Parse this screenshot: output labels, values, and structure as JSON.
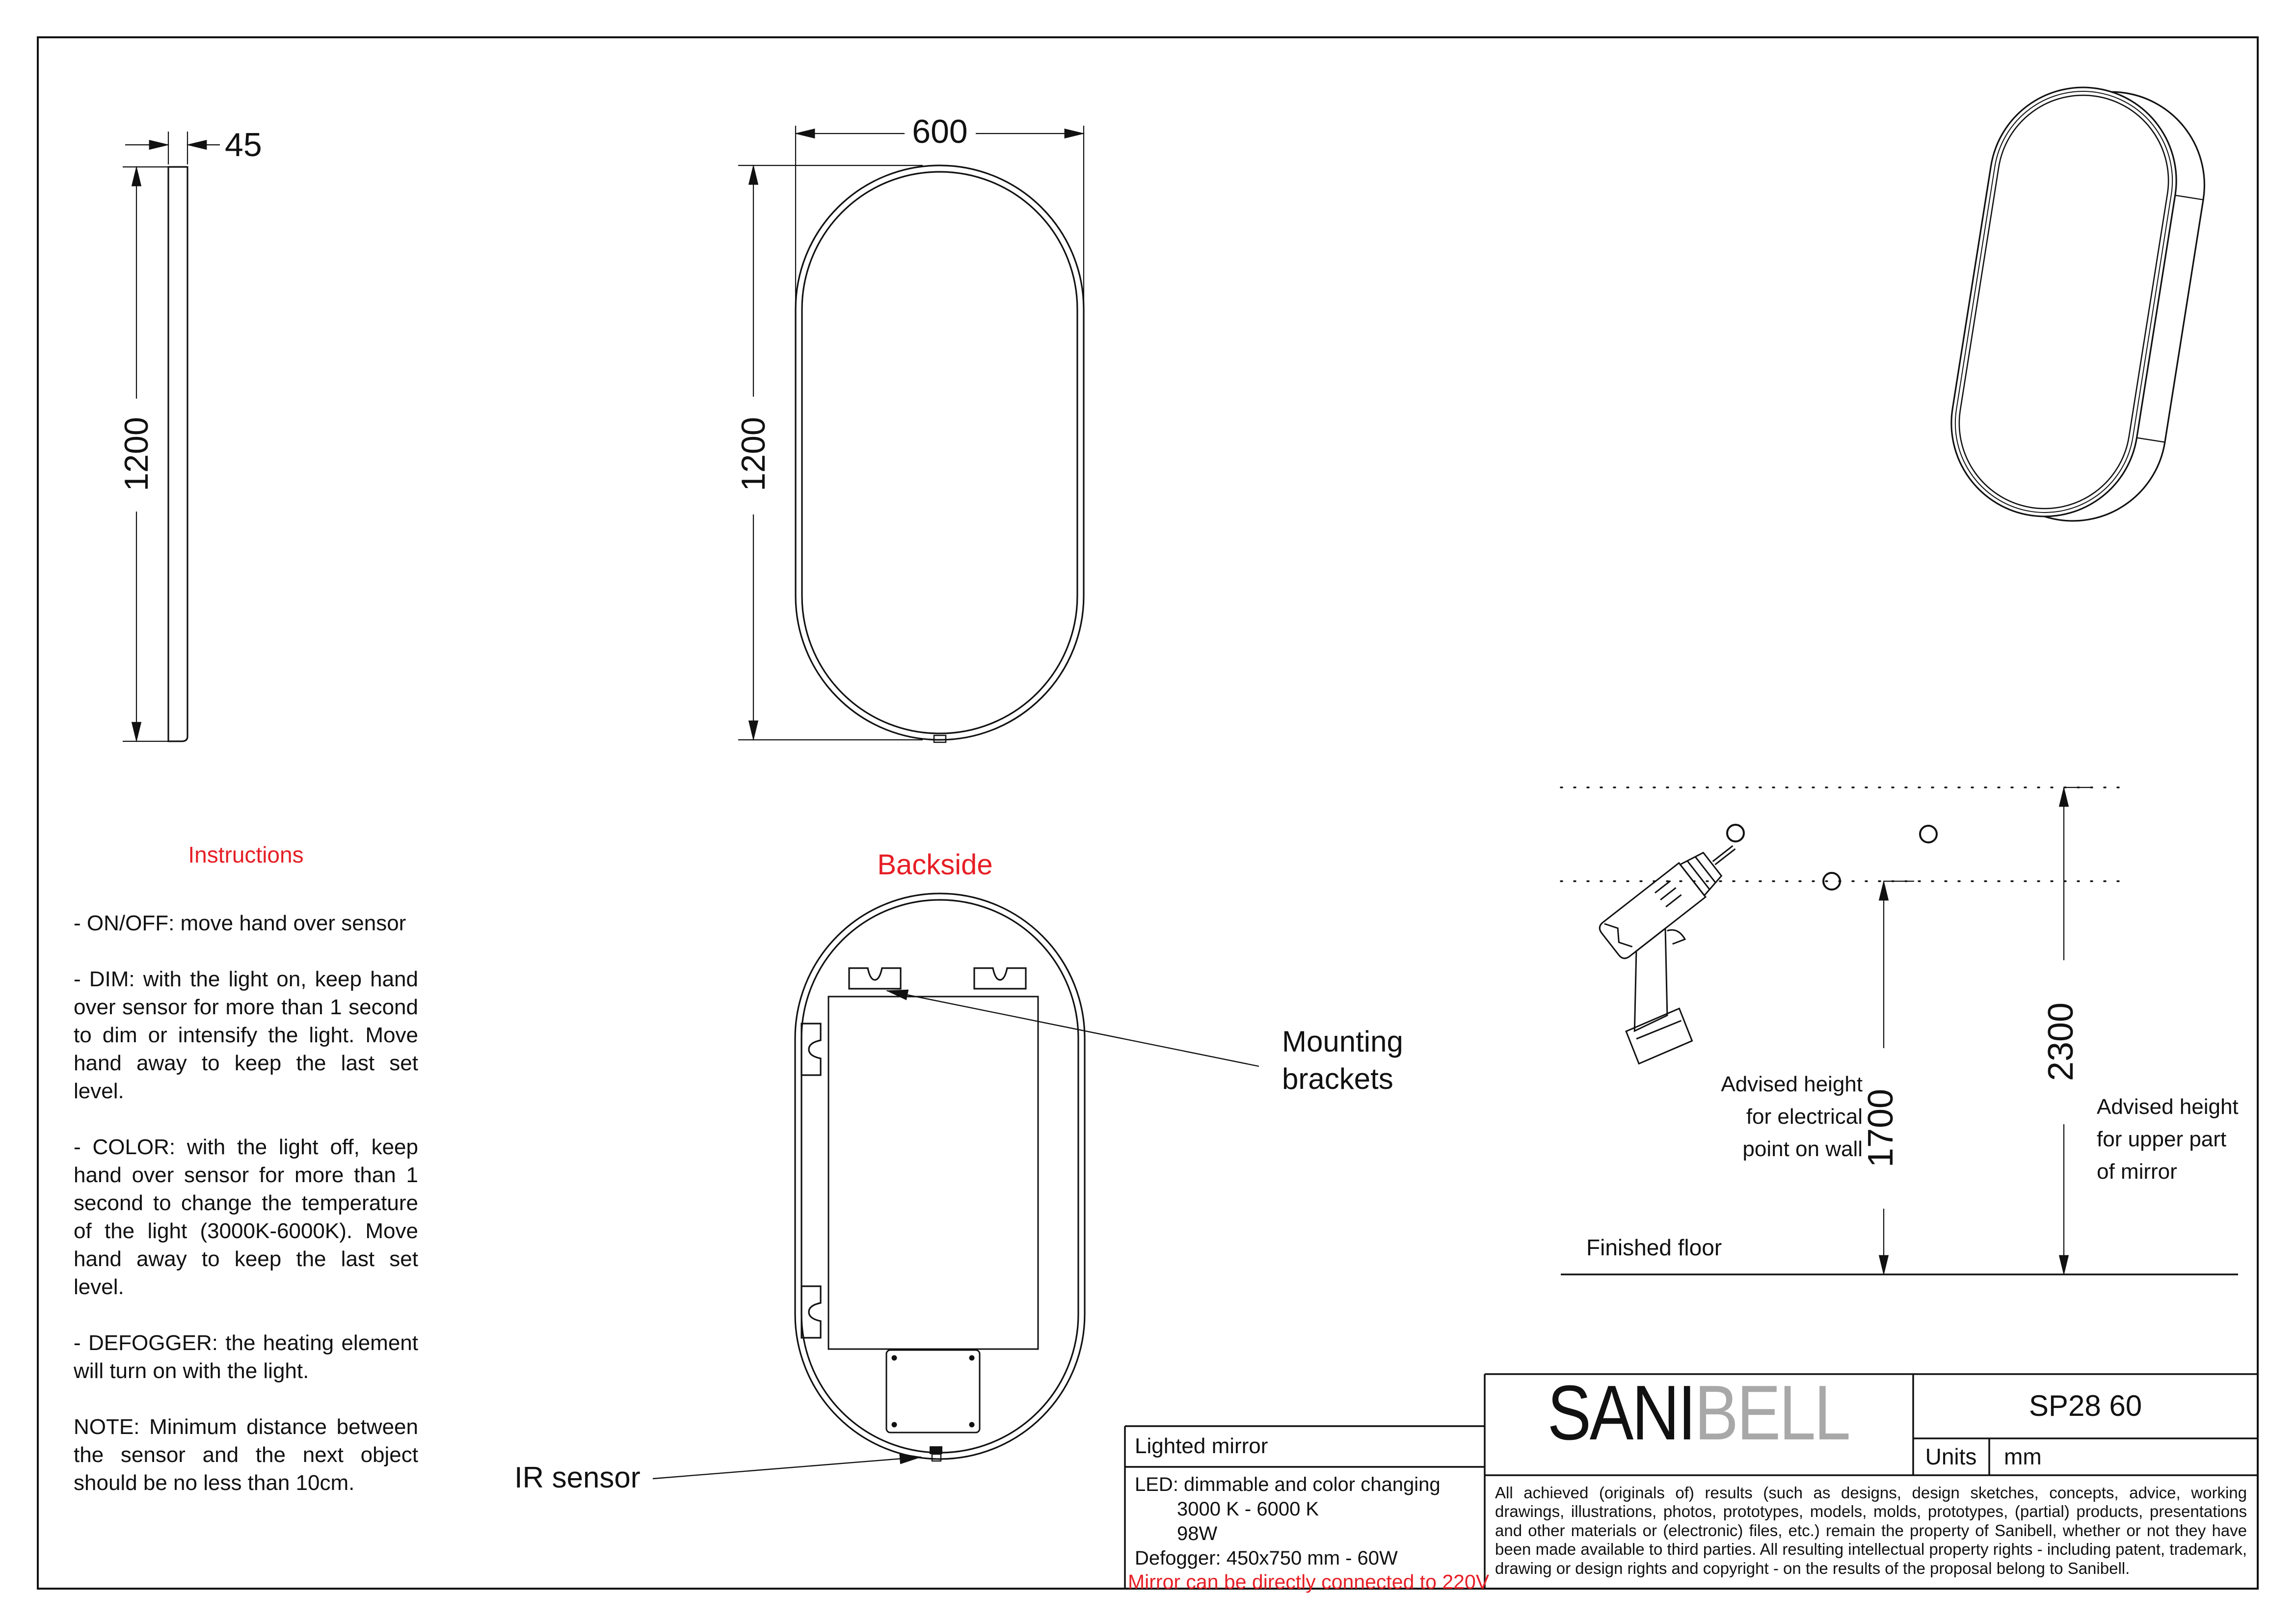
{
  "colors": {
    "accent_red": "#e61e25",
    "brand_gray": "#a8a8a8",
    "ink": "#111111"
  },
  "side_view": {
    "thickness": "45",
    "height": "1200"
  },
  "front_view": {
    "width": "600",
    "height": "1200"
  },
  "instructions": {
    "title": "Instructions",
    "items": [
      "- ON/OFF: move hand over sensor",
      "- DIM: with the light on, keep hand over sensor for more than 1 second to dim or intensify the light. Move hand away to keep the last set level.",
      "- COLOR: with the light off, keep hand over sensor for more than 1 second to change the temperature of the light (3000K-6000K). Move hand away to keep the last set level.",
      "- DEFOGGER: the heating element will turn on with the light.",
      "NOTE: Minimum distance between the sensor and the next object should be no less than 10cm."
    ]
  },
  "backside": {
    "title": "Backside",
    "mounting_lines": [
      "Mounting",
      "brackets"
    ],
    "ir_label": "IR sensor"
  },
  "installation": {
    "height_electrical": "1700",
    "height_mirror": "2300",
    "electrical_label": [
      "Advised height",
      "for electrical",
      "point on wall"
    ],
    "mirror_label": [
      "Advised height",
      "for upper part",
      "of mirror"
    ],
    "floor_label": "Finished floor"
  },
  "title_block": {
    "product": "Lighted mirror",
    "led_line1": "LED: dimmable and color changing",
    "led_line2": "3000 K - 6000 K",
    "led_line3": "98W",
    "led_line4": "Defogger: 450x750 mm - 60W",
    "warning": "Mirror can be directly connected to 220V",
    "brand_part1": "SANI",
    "brand_part2": "BELL",
    "model": "SP28 60",
    "units_label": "Units",
    "units_value": "mm",
    "legal": "All achieved (originals of) results (such as designs, design sketches, concepts, advice, working drawings, illustrations, photos, prototypes, models, molds, prototypes, (partial) products, presentations and other materials or (electronic) files, etc.) remain the property of Sanibell, whether or not they have been made available to third parties. All resulting intellectual property rights - including patent, trademark, drawing or design rights and copyright - on the results of the proposal belong to Sanibell."
  }
}
